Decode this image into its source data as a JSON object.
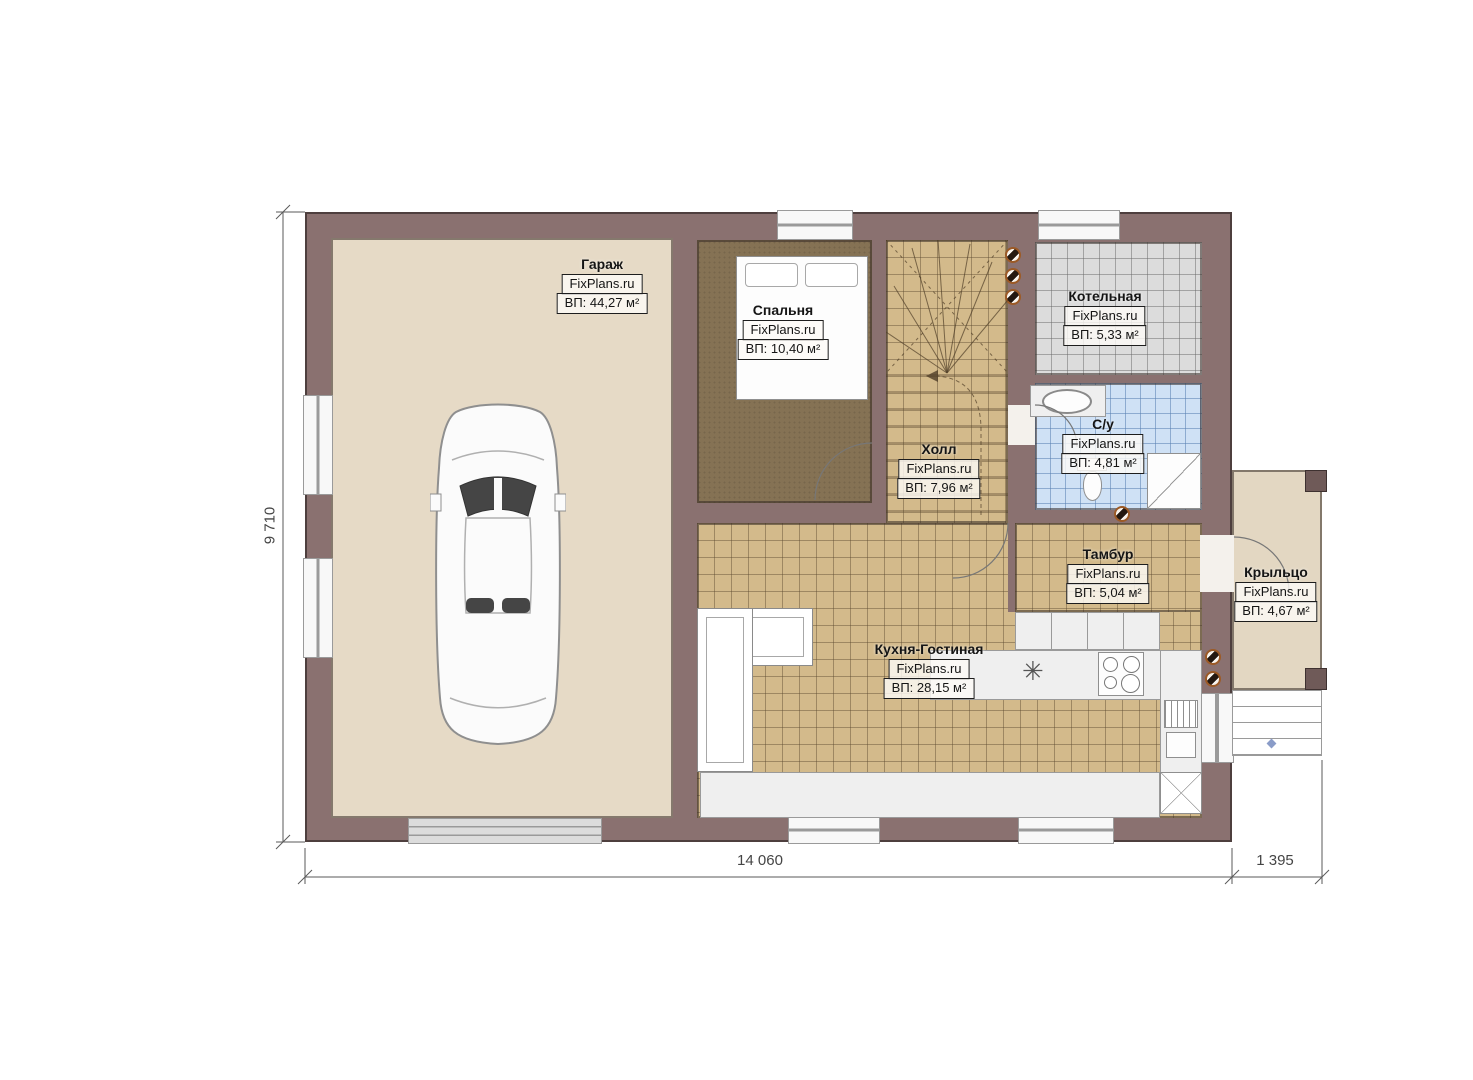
{
  "plan": {
    "brand": "FixPlans.ru",
    "rooms": [
      {
        "name": "Гараж",
        "area": "ВП: 44,27 м²"
      },
      {
        "name": "Спальня",
        "area": "ВП: 10,40 м²"
      },
      {
        "name": "Котельная",
        "area": "ВП: 5,33 м²"
      },
      {
        "name": "Холл",
        "area": "ВП: 7,96 м²"
      },
      {
        "name": "С/у",
        "area": "ВП: 4,81 м²"
      },
      {
        "name": "Тамбур",
        "area": "ВП: 5,04 м²"
      },
      {
        "name": "Кухня-Гостиная",
        "area": "ВП: 28,15 м²"
      },
      {
        "name": "Крыльцо",
        "area": "ВП: 4,67 м²"
      }
    ],
    "dimensions": {
      "left_height": "9 710",
      "bottom_main": "14 060",
      "bottom_porch": "1 395"
    },
    "colors": {
      "wall": "#8a7170",
      "garage_floor": "#e6dac6",
      "bedroom_floor": "#857254",
      "tile_tan": "#d3ba8b",
      "tile_gray": "#dcdcdc",
      "tile_blue": "#cfe1f5",
      "porch_floor": "#e3d7c2",
      "vent_ring": "#9c5a26"
    }
  }
}
